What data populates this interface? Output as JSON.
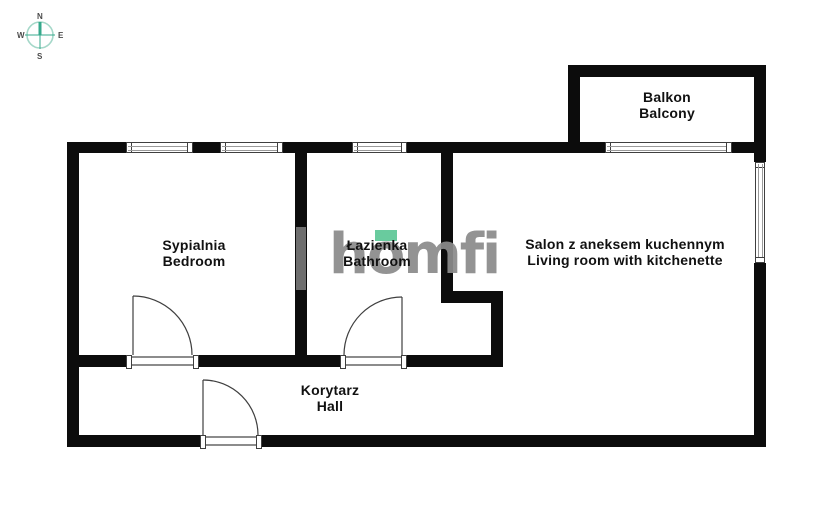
{
  "plan": {
    "rooms": {
      "bedroom": {
        "name_pl": "Sypialnia",
        "name_en": "Bedroom"
      },
      "bathroom": {
        "name_pl": "Łazienka",
        "name_en": "Bathroom"
      },
      "living_room": {
        "name_pl": "Salon z aneksem kuchennym",
        "name_en": "Living room with kitchenette"
      },
      "balcony": {
        "name_pl": "Balkon",
        "name_en": "Balcony"
      },
      "hall": {
        "name_pl": "Korytarz",
        "name_en": "Hall"
      }
    }
  },
  "compass": {
    "north": "N",
    "east": "E",
    "south": "S",
    "west": "W"
  },
  "watermark": {
    "brand": "homfi"
  },
  "colors": {
    "wall": "#0c0c0c",
    "watermark-gray": "#8b8b8b",
    "brand-green": "#5ec897",
    "compass-teal": "#36a98c",
    "compass-circle": "#a5d8c9",
    "compass-label": "#4a4a4a",
    "label-text": "#111111",
    "frame-line": "#3f3f3f",
    "sill-gray": "#8c8c8c",
    "shaft-gray": "#6e6e6e"
  }
}
